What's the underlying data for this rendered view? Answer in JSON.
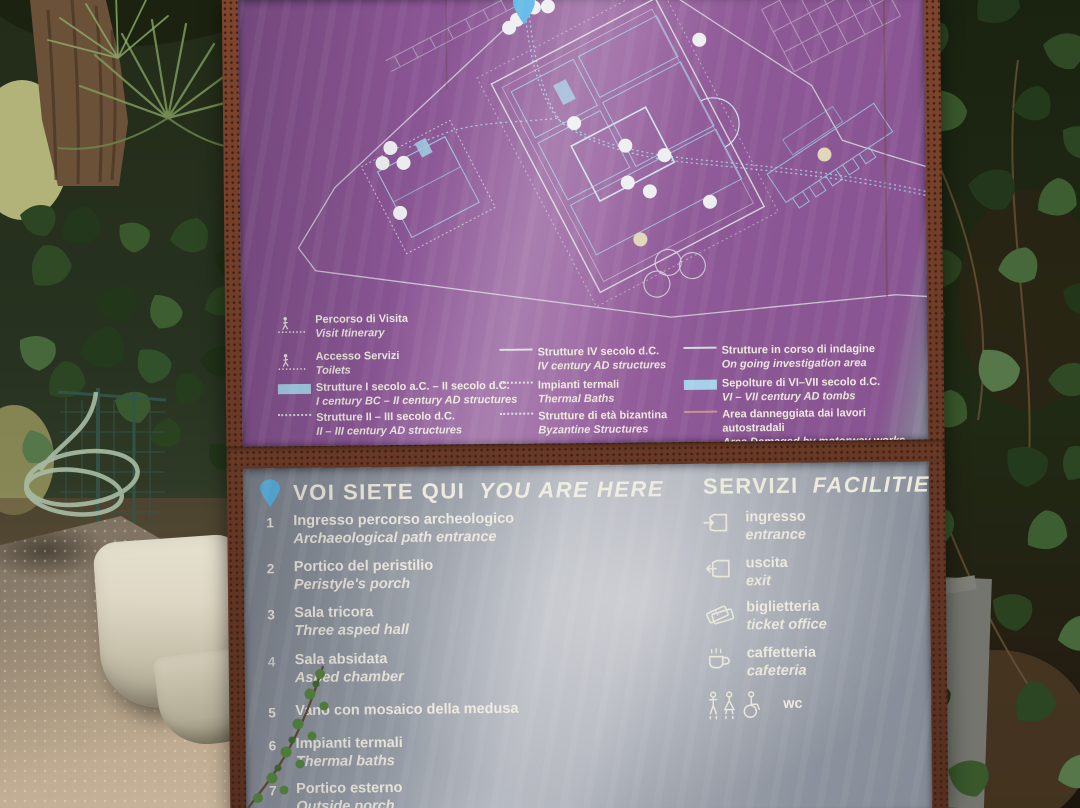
{
  "colors": {
    "panel_gray": "#8d93a0",
    "panel_highlight": "#adb1b9",
    "rust_frame": "#83492f",
    "text_white": "#ece9dd",
    "accent_blue": "#a6d0ea",
    "pin_blue": "#57b5e5",
    "map_line_white": "#e2e6e8",
    "map_line_blue": "#9cc6e0",
    "damage_red": "#c79193"
  },
  "icons": {
    "map_pin": "location-pin",
    "walk": "walking-person",
    "entrance": "door-arrow-in",
    "exit": "door-arrow-out",
    "ticket": "ticket-stub",
    "coffee": "coffee-cup",
    "wc": "man-woman-wheelchair-figures"
  },
  "sign": {
    "legend": {
      "columns": [
        {
          "items": [
            {
              "swatch": "walk",
              "it": "Percorso di Visita",
              "en": "Visit Itinerary"
            },
            {
              "swatch": "walk",
              "it": "Accesso Servizi",
              "en": "Toilets"
            },
            {
              "swatch": "bluefill",
              "it": "Strutture I secolo a.C. – II secolo d.C.",
              "en": "I century BC – II century AD structures"
            },
            {
              "swatch": "dots",
              "it": "Strutture II – III secolo d.C.",
              "en": "II – III century AD structures"
            }
          ]
        },
        {
          "items": [
            {
              "swatch": "solid",
              "it": "Strutture IV secolo d.C.",
              "en": "IV century AD structures"
            },
            {
              "swatch": "dots",
              "it": "Impianti termali",
              "en": "Thermal Baths"
            },
            {
              "swatch": "dots",
              "it": "Strutture di età bizantina",
              "en": "Byzantine Structures"
            }
          ]
        },
        {
          "items": [
            {
              "swatch": "solid",
              "it": "Strutture in corso di indagine",
              "en": "On going investigation area"
            },
            {
              "swatch": "bluefill",
              "it": "Sepolture di VI–VII secolo d.C.",
              "en": "VI – VII century AD tombs"
            },
            {
              "swatch": "redline",
              "it": "Area danneggiata dai lavori autostradali",
              "en": "Area Damaged by motorway works"
            }
          ]
        }
      ]
    },
    "lower": {
      "you_are_here": {
        "it": "VOI SIETE QUI",
        "en": "YOU ARE HERE"
      },
      "services_header": {
        "it": "SERVIZI",
        "en": "FACILITIES"
      },
      "locations": [
        {
          "num": "1",
          "it": "Ingresso percorso archeologico",
          "en": "Archaeological path entrance"
        },
        {
          "num": "2",
          "it": "Portico del peristilio",
          "en": "Peristyle's porch"
        },
        {
          "num": "3",
          "it": "Sala tricora",
          "en": "Three asped hall"
        },
        {
          "num": "4",
          "it": "Sala absidata",
          "en": "Asped chamber"
        },
        {
          "num": "5",
          "it": "Vano con mosaico della medusa",
          "en": ""
        },
        {
          "num": "6",
          "it": "Impianti termali",
          "en": "Thermal baths"
        },
        {
          "num": "7",
          "it": "Portico esterno",
          "en": "Outside porch"
        }
      ],
      "services": [
        {
          "icon": "entrance-icon",
          "it": "ingresso",
          "en": "entrance"
        },
        {
          "icon": "exit-icon",
          "it": "uscita",
          "en": "exit"
        },
        {
          "icon": "ticket-icon",
          "it": "biglietteria",
          "en": "ticket office"
        },
        {
          "icon": "coffee-icon",
          "it": "caffetteria",
          "en": "cafeteria"
        },
        {
          "icon": "wc-icon",
          "it": "wc",
          "en": ""
        }
      ]
    }
  }
}
